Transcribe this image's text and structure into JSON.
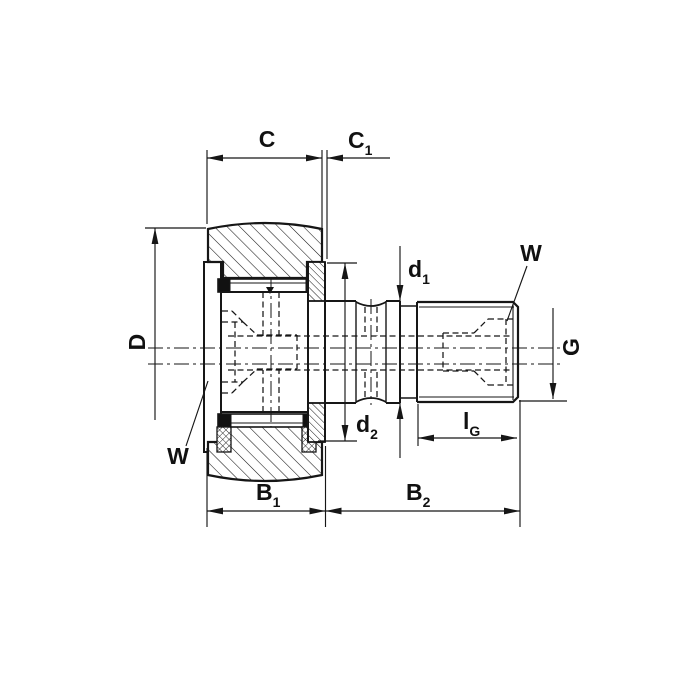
{
  "drawing": {
    "type": "engineering-cross-section",
    "subject": "stud-type track roller cam follower bearing, sectional dimension drawing",
    "line_color": "#161616",
    "background": "#ffffff",
    "labels": {
      "C": {
        "main": "C",
        "sub": ""
      },
      "C1": {
        "main": "C",
        "sub": "1"
      },
      "D": {
        "main": "D",
        "sub": ""
      },
      "W_left": {
        "main": "W",
        "sub": ""
      },
      "W_right": {
        "main": "W",
        "sub": ""
      },
      "d1": {
        "main": "d",
        "sub": "1"
      },
      "d2": {
        "main": "d",
        "sub": "2"
      },
      "B1": {
        "main": "B",
        "sub": "1"
      },
      "B2": {
        "main": "B",
        "sub": "2"
      },
      "G": {
        "main": "G",
        "sub": ""
      },
      "lG": {
        "main": "l",
        "sub": "G"
      }
    }
  }
}
